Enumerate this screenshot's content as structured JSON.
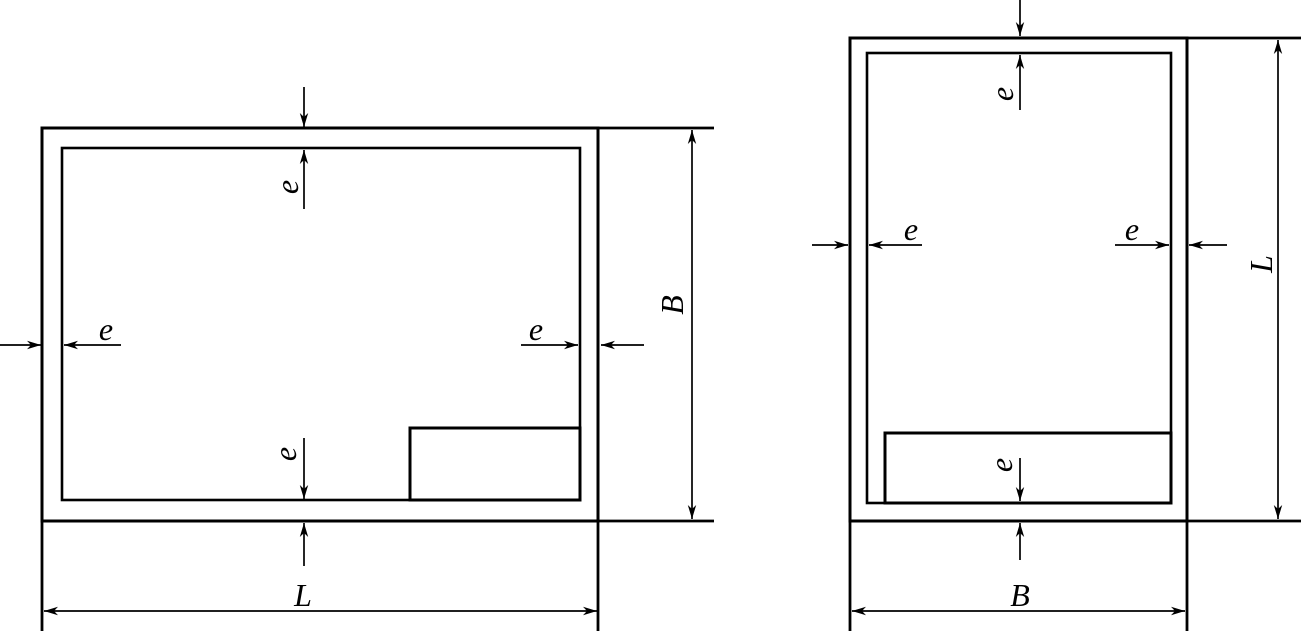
{
  "diagram": {
    "colors": {
      "line": "#000000",
      "background": "#ffffff"
    },
    "landscape_sheet": {
      "margin_top_label": "e",
      "margin_bottom_label": "e",
      "margin_left_label": "e",
      "margin_right_label": "e",
      "height_dim_label": "B",
      "width_dim_label": "L"
    },
    "portrait_sheet": {
      "margin_top_label": "e",
      "margin_bottom_label": "e",
      "margin_left_label": "e",
      "margin_right_label": "e",
      "height_dim_label": "L",
      "width_dim_label": "B"
    }
  }
}
